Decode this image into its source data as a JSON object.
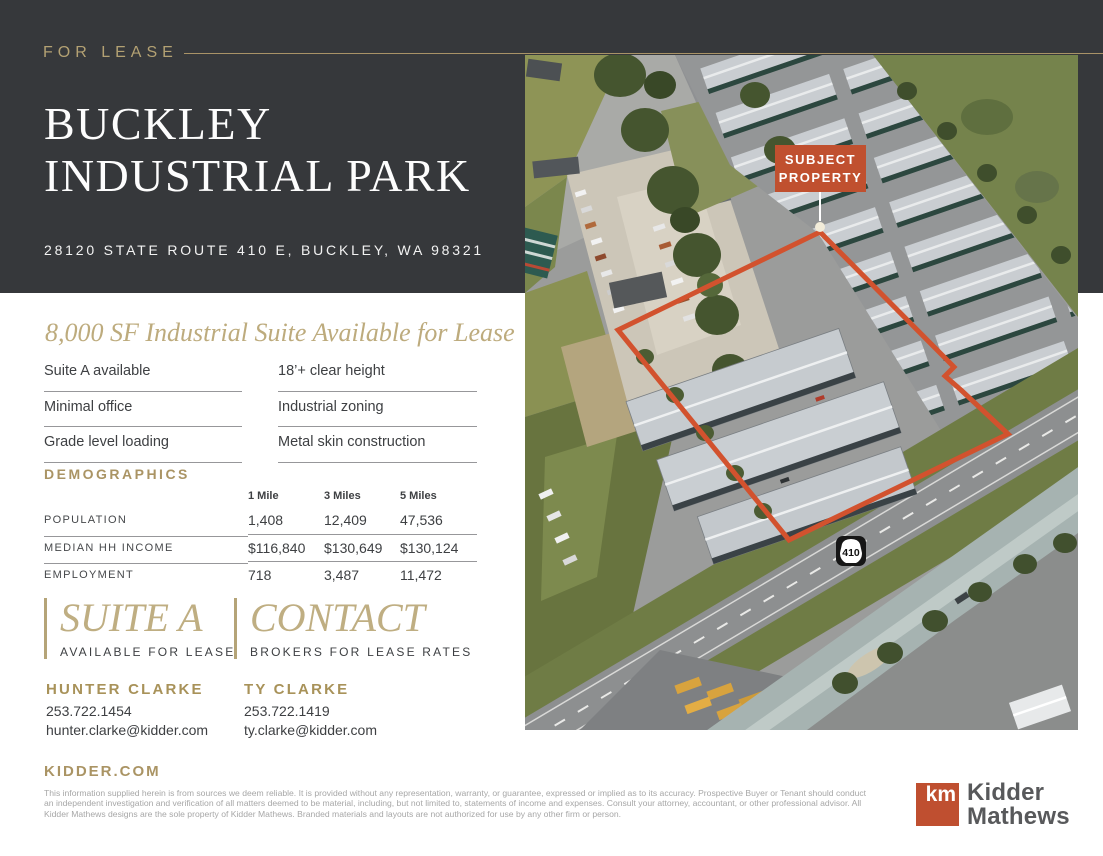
{
  "header": {
    "label": "FOR LEASE",
    "title_line1": "BUCKLEY",
    "title_line2": "INDUSTRIAL PARK",
    "address": "28120 STATE ROUTE 410 E, BUCKLEY, WA 98321",
    "band_color": "#36383b",
    "accent_gold": "#a99367"
  },
  "overview": {
    "tagline": "8,000 SF Industrial Suite Available for Lease",
    "features_left": [
      "Suite A available",
      "Minimal office",
      "Grade level loading"
    ],
    "features_right": [
      "18’+ clear height",
      "Industrial zoning",
      "Metal skin construction"
    ]
  },
  "demographics": {
    "heading": "DEMOGRAPHICS",
    "columns": [
      "1 Mile",
      "3 Miles",
      "5 Miles"
    ],
    "rows": [
      {
        "label": "POPULATION",
        "values": [
          "1,408",
          "12,409",
          "47,536"
        ]
      },
      {
        "label": "MEDIAN HH INCOME",
        "values": [
          "$116,840",
          "$130,649",
          "$130,124"
        ]
      },
      {
        "label": "EMPLOYMENT",
        "values": [
          "718",
          "3,487",
          "11,472"
        ]
      }
    ]
  },
  "callouts": [
    {
      "title": "SUITE A",
      "subtitle": "AVAILABLE FOR LEASE"
    },
    {
      "title": "CONTACT",
      "subtitle": "BROKERS FOR LEASE RATES"
    }
  ],
  "brokers": [
    {
      "name": "HUNTER CLARKE",
      "phone": "253.722.1454",
      "email": "hunter.clarke@kidder.com"
    },
    {
      "name": "TY CLARKE",
      "phone": "253.722.1419",
      "email": "ty.clarke@kidder.com"
    }
  ],
  "map": {
    "callout_line1": "SUBJECT",
    "callout_line2": "PROPERTY",
    "callout_bg": "#c0502f",
    "outline_color": "#d2522e",
    "route_shield": "410"
  },
  "footer": {
    "website": "KIDDER.COM",
    "disclaimer": "This information supplied herein is from sources we deem reliable. It is provided without any representation, warranty, or guarantee, expressed or implied as to its accuracy. Prospective Buyer or Tenant should conduct an independent investigation and verification of all matters deemed to be material, including, but not limited to, statements of income and expenses. Consult your attorney, accountant, or other professional advisor.  All Kidder Mathews designs are the sole property of Kidder Mathews. Branded materials and layouts are not authorized for use by any other firm or person.",
    "logo_mark": "km",
    "logo_line1": "Kidder",
    "logo_line2": "Mathews",
    "logo_color": "#bf4f30"
  }
}
